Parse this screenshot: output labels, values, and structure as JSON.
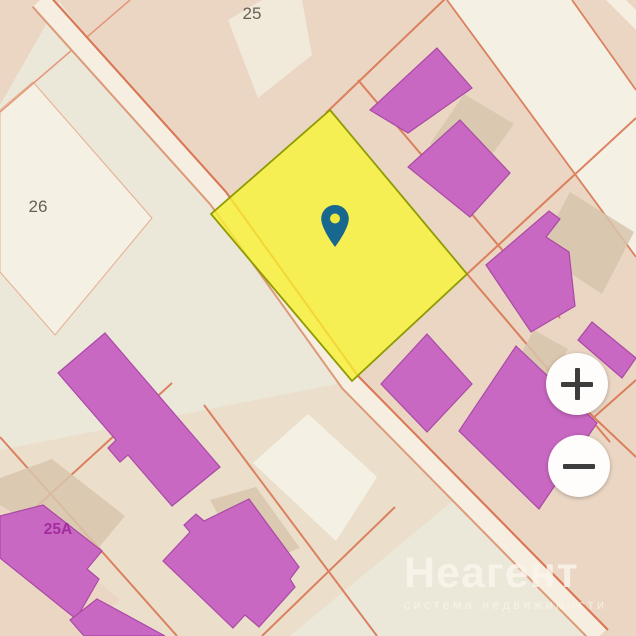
{
  "app": {
    "view": "cadastral-map"
  },
  "map": {
    "parcel_labels": [
      {
        "id": "parcel-25",
        "text": "25"
      },
      {
        "id": "parcel-26",
        "text": "26"
      },
      {
        "id": "parcel-25a",
        "text": "25A"
      }
    ],
    "selected_parcel": {
      "highlighted": true,
      "fill": "#f8f032",
      "border": "#8f9b00"
    },
    "marker": {
      "icon": "map-pin-icon",
      "color": "#17678f"
    }
  },
  "controls": {
    "zoom_in_icon": "plus-icon",
    "zoom_out_icon": "minus-icon"
  },
  "watermark": {
    "brand": "Неагент",
    "tagline": "система недвижимости"
  },
  "palette": {
    "base": "#ebe8da",
    "beige": "#ead6c3",
    "beige2": "#ebdfcc",
    "white-parcel": "#f4f1e4",
    "road-fill": "#f6eee1",
    "road-casing": "#dd9a78",
    "line": "#d9704c",
    "line-soft": "#e4987b",
    "shadow-poly": "#d8c5ad",
    "building": "#c968c3",
    "building-stroke": "#aa4aa5",
    "selected-fill": "#f8f032",
    "selected-stroke": "#8f9b00",
    "pin": "#17678f",
    "pin-hole": "#eee73e",
    "label-gray": "#675f53",
    "label-magenta": "#a32c9e",
    "btn-bg": "#fefdfc",
    "btn-glyph": "#3d3d3d",
    "wm": "#fbf5ec"
  }
}
